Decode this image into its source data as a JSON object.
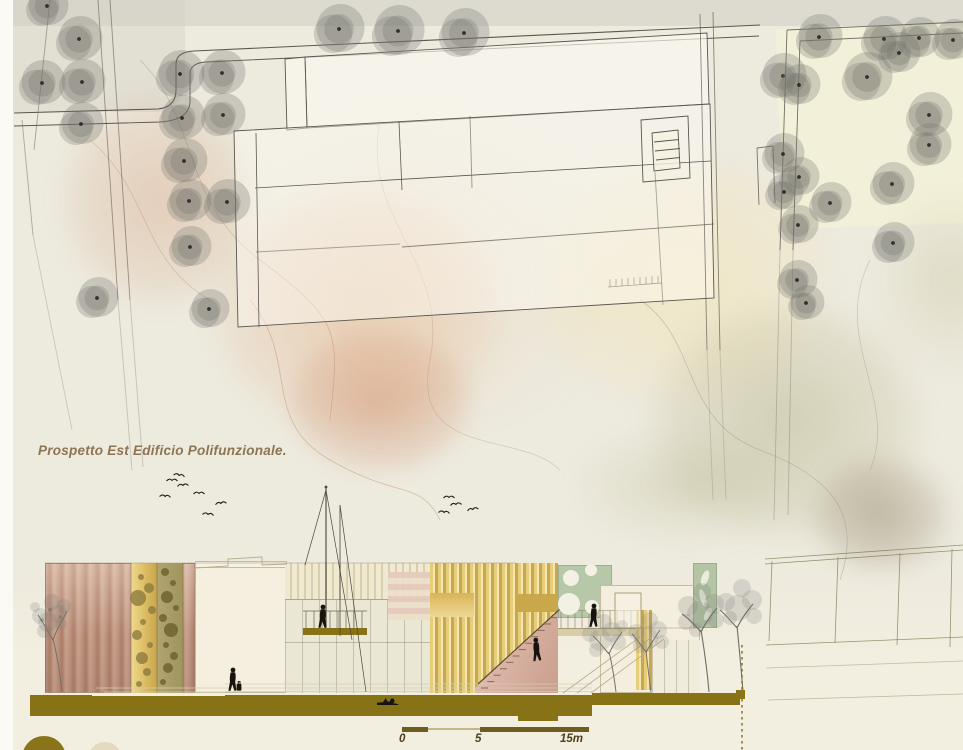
{
  "board": {
    "elevation_label": "Prospetto Est Edificio Polifunzionale.",
    "scale_bar": {
      "ticks": [
        "0",
        "5",
        "15m"
      ]
    },
    "palette": {
      "paper": "#edeade",
      "margin_white": "#fbfaf5",
      "ink_line": "#5b5750",
      "tree_gray": "#7a7871",
      "wash_peach": "#e2a880",
      "wash_rose": "#cb7e56",
      "wash_olive": "#aca87a",
      "wash_taupe": "#928668",
      "copper_facade": "#c59b86",
      "gold_louver": "#e6cd7a",
      "olive_ground": "#877315",
      "sage_panel": "#b6c8a8",
      "pink_stair": "#d9b3a6",
      "silhouette_black": "#17140f",
      "label_brown": "#8d7453",
      "scale_text": "#4f3f1a"
    }
  },
  "site_plan": {
    "trees": [
      [
        47,
        6,
        20
      ],
      [
        79,
        39,
        22
      ],
      [
        42,
        83,
        22
      ],
      [
        82,
        82,
        22
      ],
      [
        81,
        124,
        21
      ],
      [
        180,
        74,
        23
      ],
      [
        222,
        73,
        22
      ],
      [
        182,
        118,
        22
      ],
      [
        223,
        115,
        21
      ],
      [
        184,
        161,
        22
      ],
      [
        189,
        201,
        21
      ],
      [
        227,
        202,
        22
      ],
      [
        97,
        298,
        20
      ],
      [
        190,
        247,
        20
      ],
      [
        209,
        309,
        19
      ],
      [
        339,
        29,
        24
      ],
      [
        398,
        31,
        25
      ],
      [
        464,
        33,
        24
      ]
    ],
    "park_trees": [
      [
        819,
        37,
        22
      ],
      [
        884,
        39,
        22
      ],
      [
        919,
        38,
        20
      ],
      [
        953,
        40,
        20
      ],
      [
        783,
        76,
        22
      ],
      [
        799,
        85,
        20
      ],
      [
        867,
        77,
        24
      ],
      [
        899,
        53,
        20
      ],
      [
        929,
        115,
        22
      ],
      [
        929,
        145,
        21
      ],
      [
        892,
        184,
        21
      ],
      [
        783,
        154,
        20
      ],
      [
        799,
        177,
        19
      ],
      [
        784,
        192,
        18
      ],
      [
        830,
        203,
        20
      ],
      [
        798,
        225,
        19
      ],
      [
        893,
        243,
        20
      ],
      [
        797,
        280,
        19
      ],
      [
        806,
        303,
        17
      ]
    ]
  },
  "birds": {
    "flock_a": [
      [
        172,
        481,
        0
      ],
      [
        179,
        476,
        10
      ],
      [
        183,
        486,
        -5
      ],
      [
        165,
        497,
        5
      ],
      [
        199,
        494,
        0
      ],
      [
        221,
        504,
        -8
      ],
      [
        208,
        515,
        6
      ]
    ],
    "flock_b": [
      [
        449,
        498,
        0
      ],
      [
        456,
        505,
        -6
      ],
      [
        444,
        513,
        5
      ],
      [
        473,
        510,
        -10
      ]
    ]
  },
  "elevation": {
    "facade_dots_gold": [
      [
        141,
        577,
        3
      ],
      [
        149,
        588,
        5
      ],
      [
        138,
        598,
        8
      ],
      [
        152,
        610,
        4
      ],
      [
        143,
        622,
        3
      ],
      [
        137,
        635,
        5
      ],
      [
        150,
        645,
        3
      ],
      [
        142,
        658,
        6
      ],
      [
        147,
        672,
        4
      ],
      [
        139,
        684,
        3
      ]
    ],
    "facade_dots_olive": [
      [
        165,
        572,
        4
      ],
      [
        173,
        583,
        3
      ],
      [
        167,
        597,
        6
      ],
      [
        176,
        608,
        3
      ],
      [
        163,
        618,
        4
      ],
      [
        171,
        630,
        7
      ],
      [
        166,
        645,
        3
      ],
      [
        174,
        656,
        4
      ],
      [
        168,
        668,
        5
      ],
      [
        163,
        682,
        3
      ]
    ],
    "sage_circles": [
      [
        571,
        578,
        8
      ],
      [
        591,
        570,
        6
      ],
      [
        569,
        604,
        11
      ],
      [
        592,
        607,
        7
      ]
    ],
    "leaf_shapes": [
      [
        705,
        578,
        3.5,
        8,
        20
      ],
      [
        703,
        598,
        3,
        9,
        -15
      ],
      [
        708,
        614,
        3,
        7,
        25
      ]
    ],
    "people": [
      {
        "name": "pedestrian-with-luggage",
        "x": 233,
        "y": 691,
        "pose": "standing",
        "luggage": true
      },
      {
        "name": "person-on-balcony",
        "x": 323,
        "y": 628,
        "pose": "standing"
      },
      {
        "name": "person-on-stair",
        "x": 538,
        "y": 661,
        "pose": "standing",
        "rot": -6
      },
      {
        "name": "person-on-bridge",
        "x": 594,
        "y": 627,
        "pose": "standing"
      },
      {
        "name": "person-reclining",
        "x": 388,
        "y": 705,
        "pose": "reclining"
      }
    ]
  }
}
